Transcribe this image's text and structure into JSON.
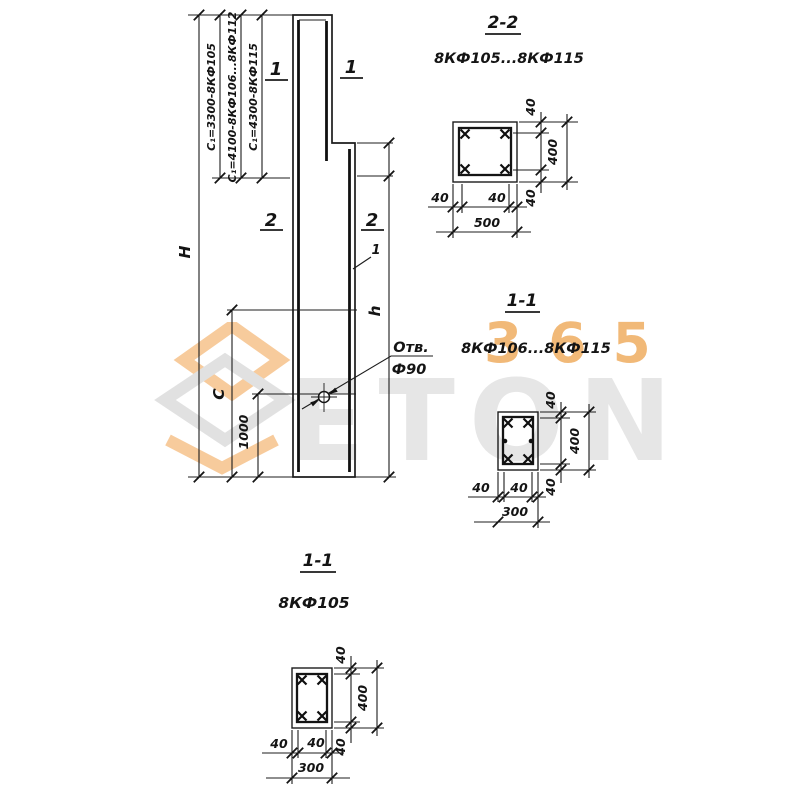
{
  "watermark": {
    "brand_text": "ETON",
    "badge_text": "365",
    "orange": "#f0a04a",
    "gray": "#c9c9c9"
  },
  "elevation": {
    "dims": {
      "overall_height": "H",
      "lower_height": "h",
      "upper_zone": "C",
      "hole_offset": "1000"
    },
    "length_options": [
      "C₁=3300-8КФ105",
      "C₁=4100-8КФ106...8КФ112",
      "C₁=4300-8КФ115"
    ],
    "hole": {
      "label": "Отв.",
      "diameter": "Ф90"
    },
    "marks": {
      "section1": "1",
      "section2": "2",
      "rebar": "1"
    }
  },
  "sections": {
    "s22": {
      "title": "2-2",
      "subtitle": "8КФ105...8КФ115",
      "width": "500",
      "height": "400",
      "cover": "40"
    },
    "s11_mid": {
      "title": "1-1",
      "subtitle": "8КФ106...8КФ115",
      "width": "300",
      "height": "400",
      "cover": "40"
    },
    "s11_bottom": {
      "title": "1-1",
      "subtitle": "8КФ105",
      "width": "300",
      "height": "400",
      "cover": "40"
    }
  }
}
